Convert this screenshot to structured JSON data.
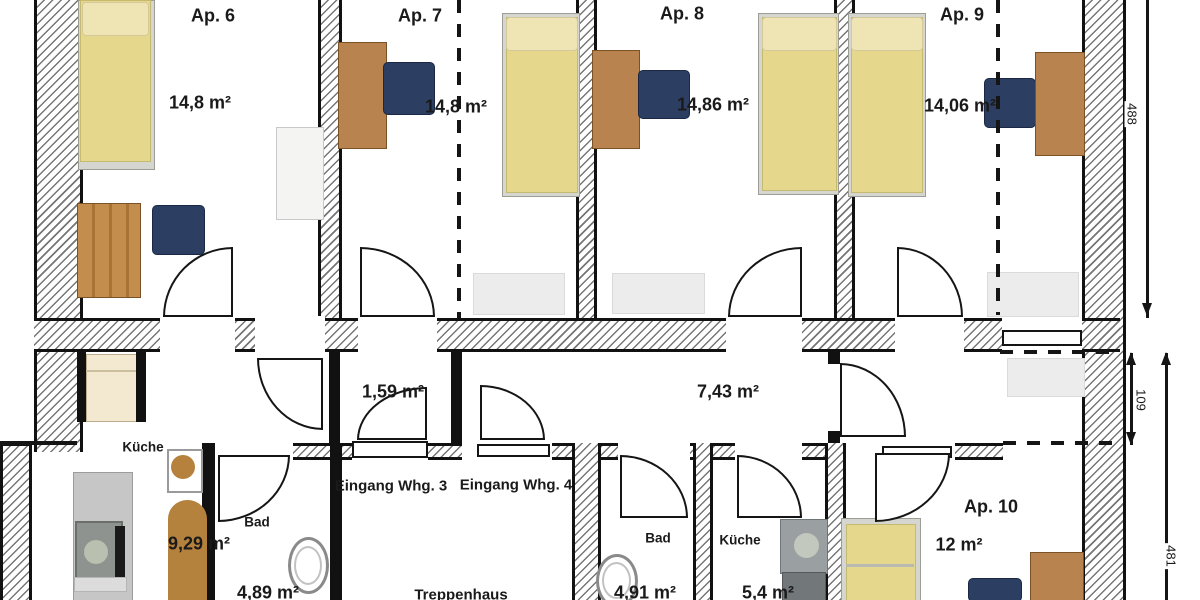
{
  "apartments": [
    {
      "name": "Ap. 6",
      "area": "14,8 m²"
    },
    {
      "name": "Ap. 7",
      "area": "14,8 m²"
    },
    {
      "name": "Ap. 8",
      "area": "14,86 m²"
    },
    {
      "name": "Ap. 9",
      "area": "14,06 m²"
    },
    {
      "name": "Ap. 10",
      "area": "12 m²"
    }
  ],
  "rooms": {
    "hall_whg3": {
      "area": "1,59 m²"
    },
    "corridor_whg4": {
      "area": "7,43 m²"
    },
    "kitchen_whg3": {
      "name": "Küche",
      "area": "9,29 m²"
    },
    "bath_whg3": {
      "name": "Bad",
      "area": "4,89 m²"
    },
    "stairwell": {
      "name": "Treppenhaus"
    },
    "bath_whg4": {
      "name": "Bad",
      "area": "4,91 m²"
    },
    "kitchen_whg4": {
      "name": "Küche",
      "area": "5,4 m²"
    }
  },
  "entrances": {
    "whg3": "Eingang Whg. 3",
    "whg4": "Eingang Whg. 4"
  },
  "dimensions_cm": {
    "upper_right": "488",
    "recess_right": "109",
    "lower_right": "481"
  },
  "colors": {
    "wall": "#111111",
    "bed_yellow": "#e5d88d",
    "wood_brown": "#b8834e",
    "chair_navy": "#2c3f63"
  }
}
